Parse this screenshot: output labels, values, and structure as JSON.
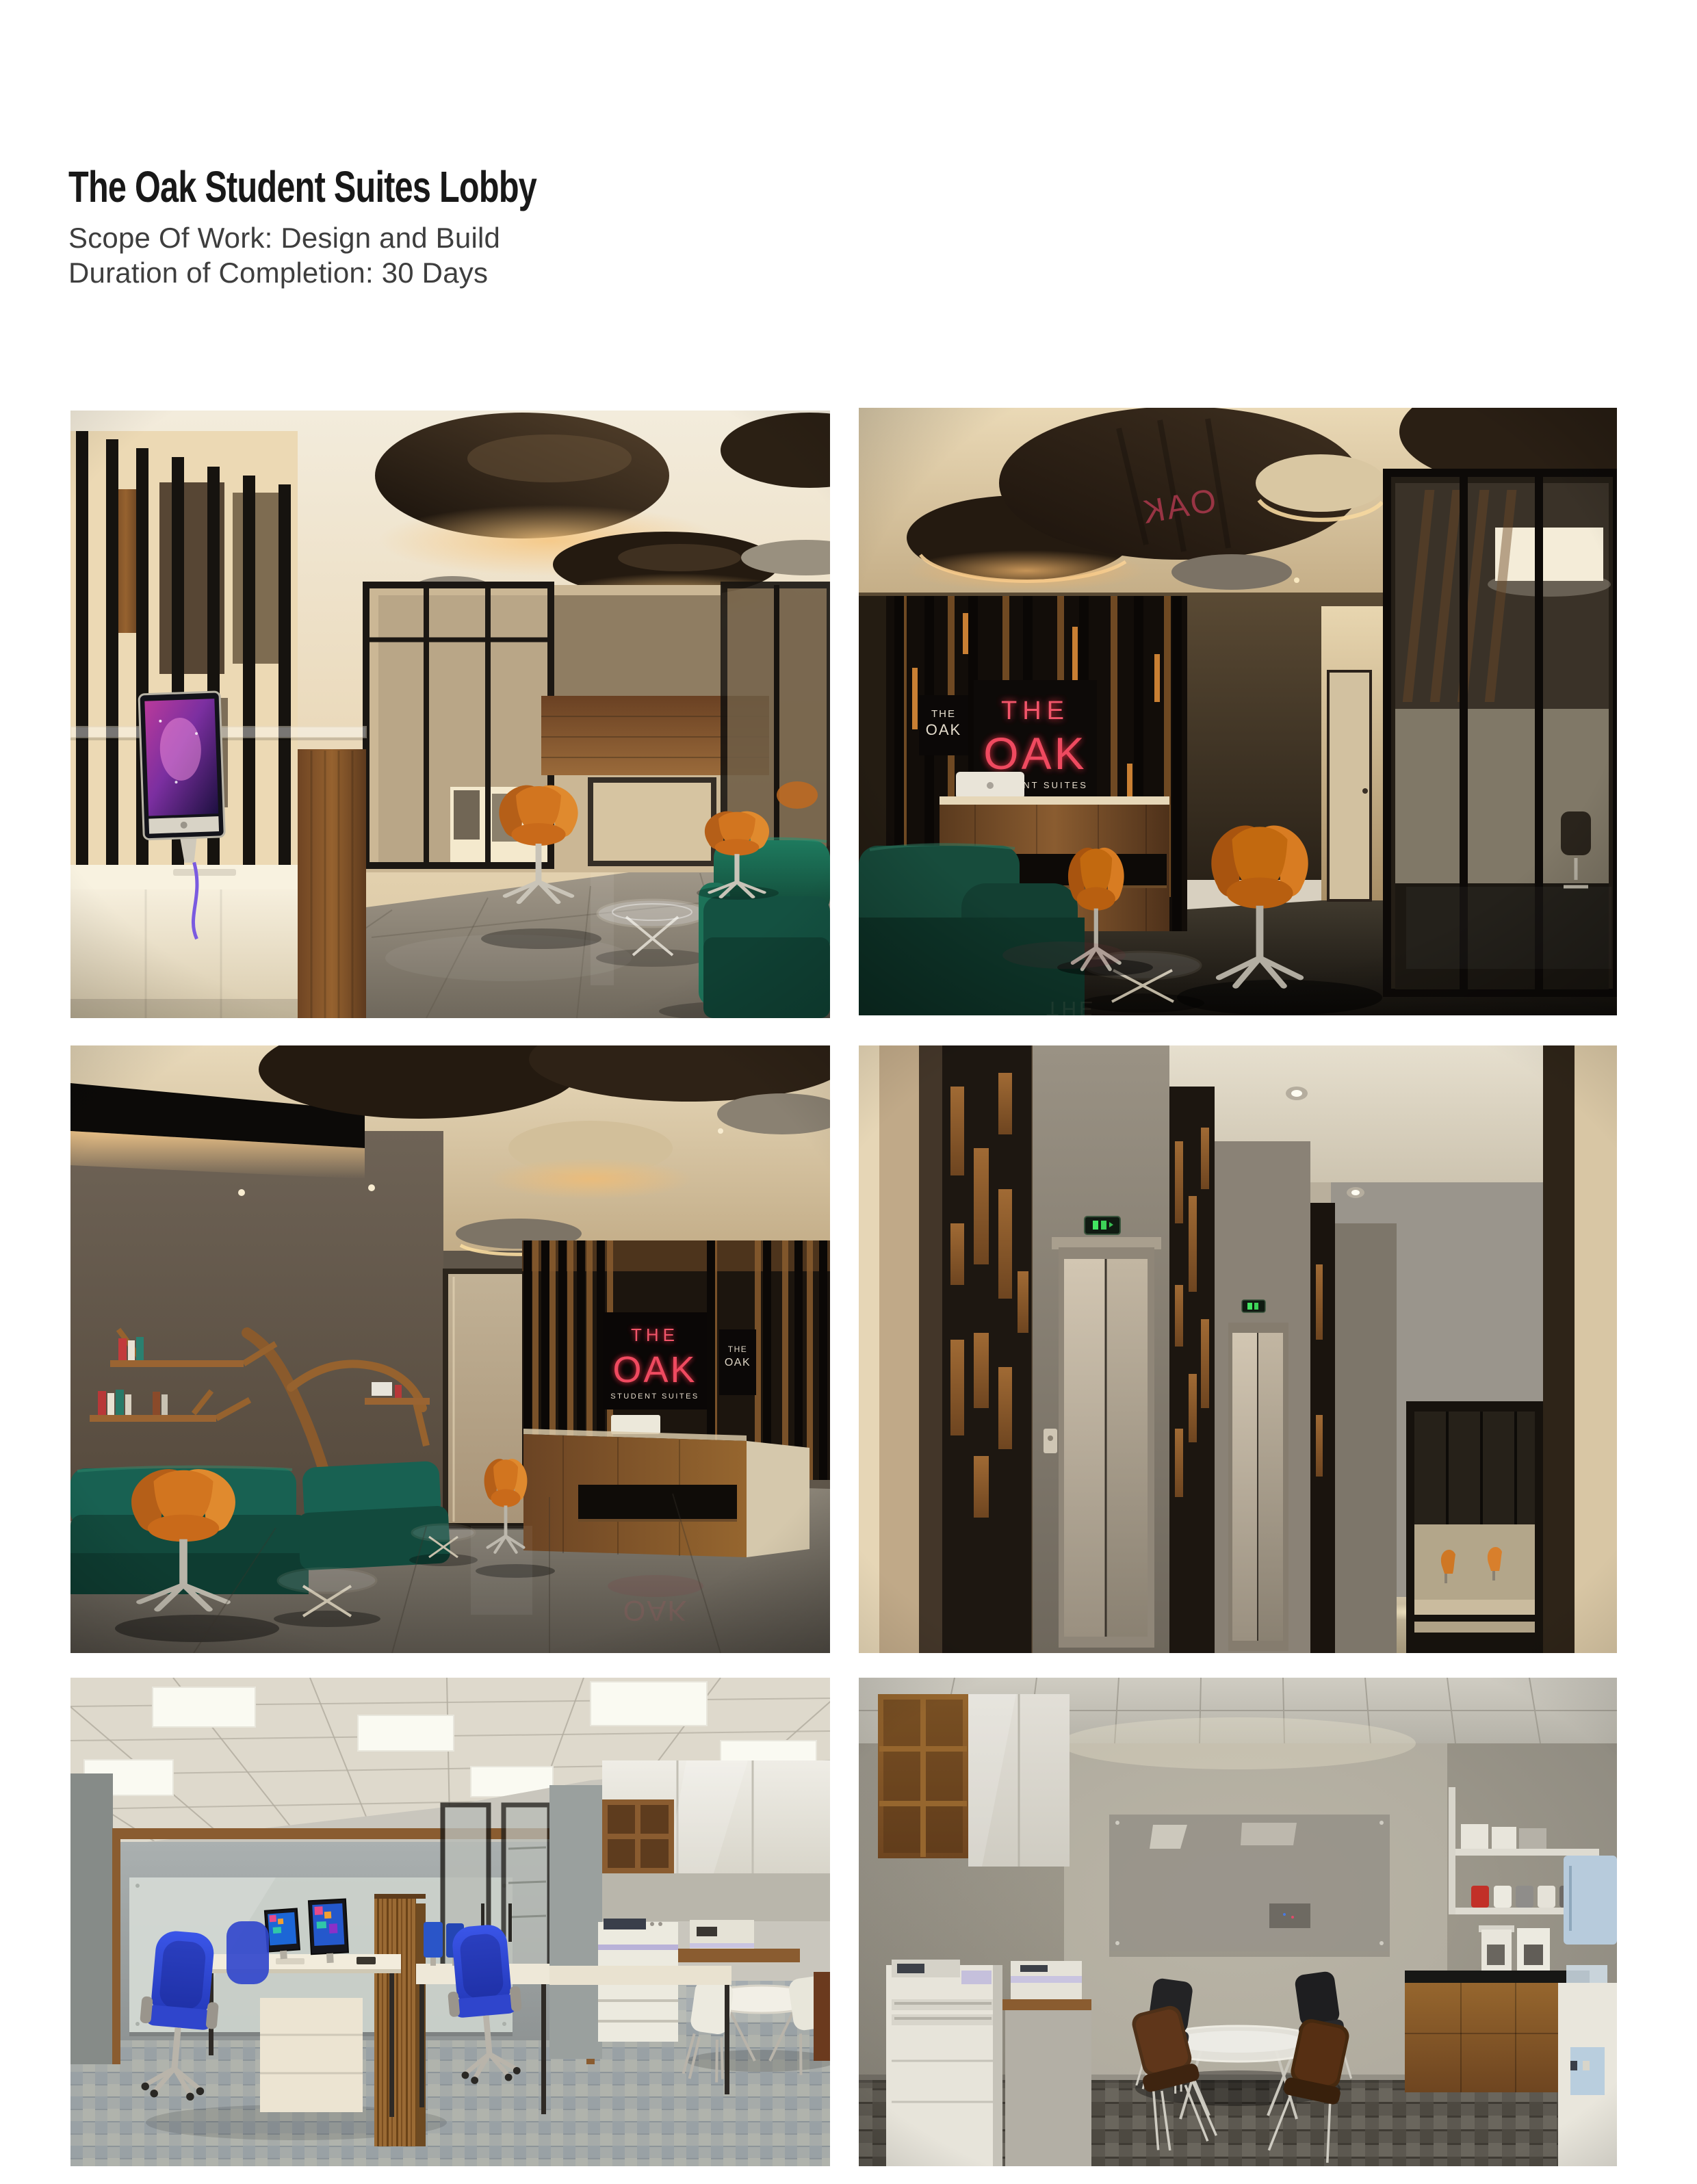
{
  "document": {
    "title": "The Oak Student Suites Lobby",
    "details": [
      "Scope Of Work: Design and Build",
      "Duration of Completion: 30 Days"
    ]
  },
  "branding": {
    "sign_the": "THE",
    "sign_oak": "OAK",
    "sign_subtitle": "STUDENT SUITES"
  },
  "palette": {
    "neon_red": "#ef4a60",
    "teal_sofa": "#17604c",
    "orange_chair": "#d8792a",
    "wood": "#8a5a30",
    "page_background": "#ffffff"
  }
}
